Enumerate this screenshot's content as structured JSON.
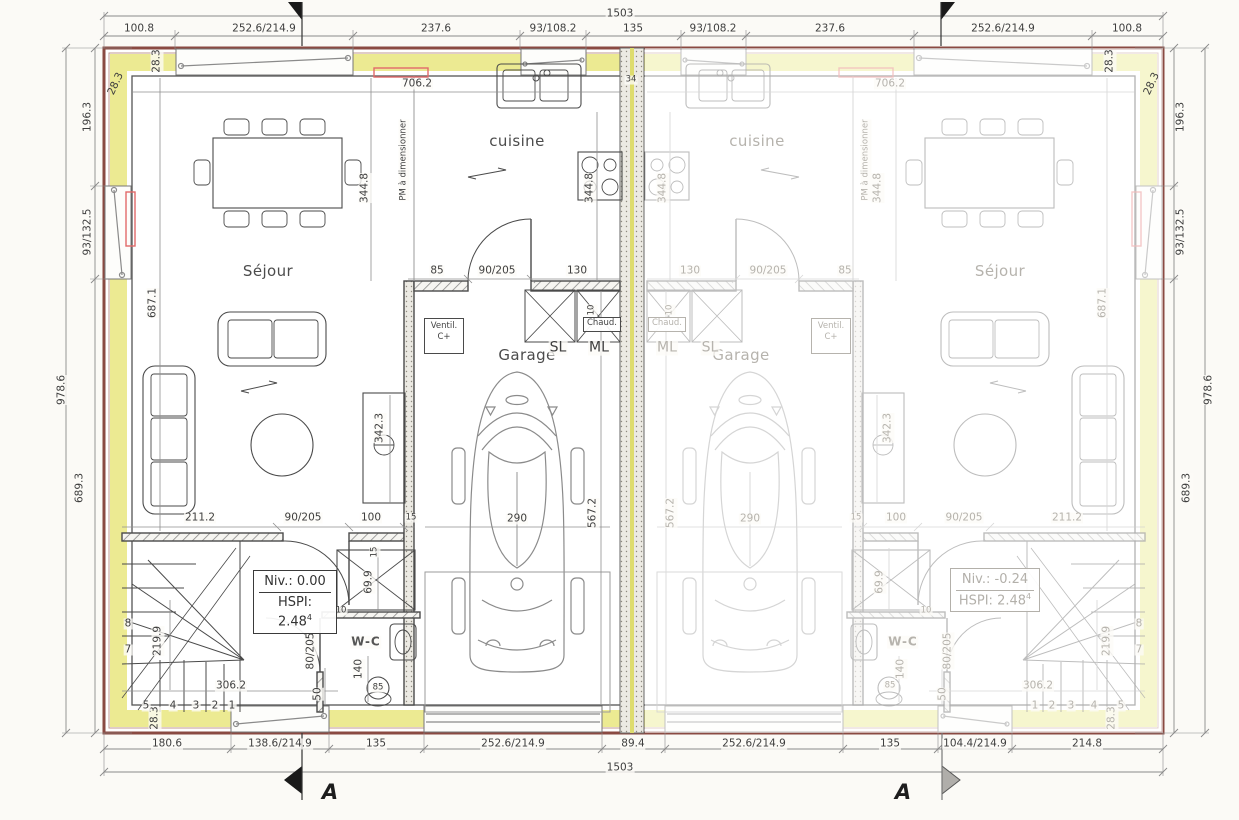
{
  "dims": {
    "overall": "1503",
    "top": [
      "100.8",
      "252.6/214.9",
      "237.6",
      "93/108.2",
      "135",
      "93/108.2",
      "237.6",
      "252.6/214.9",
      "100.8"
    ],
    "bottom": [
      "180.6",
      "138.6/214.9",
      "135",
      "252.6/214.9",
      "89.4",
      "252.6/214.9",
      "135",
      "104.4/214.9",
      "214.8"
    ],
    "side": {
      "s196": "196.3",
      "s93": "93/132.5",
      "s689": "689.3",
      "s978": "978.6",
      "s283": "28.3"
    },
    "interior": {
      "d706": "706.2",
      "d344": "344.8",
      "d687": "687.1",
      "d342": "342.3",
      "d2112": "211.2",
      "d90205": "90/205",
      "d80205": "80/205",
      "d100": "100",
      "d85": "85",
      "d130": "130",
      "d290": "290",
      "d5672": "567.2",
      "d699": "69.9",
      "d140": "140",
      "d50": "50",
      "d10": "10",
      "d15": "15",
      "d34": "34",
      "d2199": "219.9",
      "d3062": "306.2"
    }
  },
  "rooms": {
    "sejour": "Séjour",
    "cuisine": "cuisine",
    "garage": "Garage",
    "wc": "W-C",
    "sl": "SL",
    "ml": "ML",
    "chaud": "Chaud.",
    "ventil1": "Ventil.",
    "ventil2": "C+",
    "pm": "PM à dimensionner"
  },
  "levels": {
    "niv_left": "Niv.: 0.00",
    "niv_right": "Niv.: -0.24",
    "hspi": "HSPI: 2.48",
    "hspi_sup": "4"
  },
  "stairs": {
    "n1": "1",
    "n2": "2",
    "n3": "3",
    "n4": "4",
    "n5": "5",
    "n7": "7",
    "n8": "8"
  },
  "section": {
    "label": "A"
  }
}
